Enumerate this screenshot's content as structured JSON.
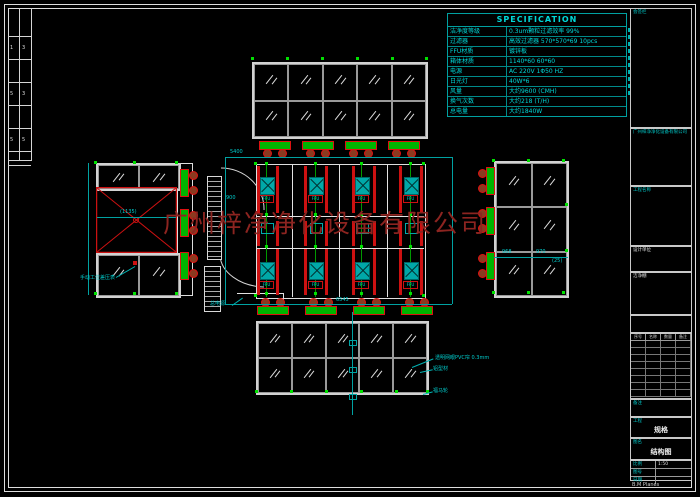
{
  "watermark": "广州梓净净化设备有限公司",
  "spec": {
    "title": "SPECIFICATION",
    "rows": [
      {
        "label": "洁净度等级",
        "value": "0.3um颗粒过滤效率 99%"
      },
      {
        "label": "过滤器",
        "value": "高效过滤器 570*570*69 10pcs"
      },
      {
        "label": "FFU材质",
        "value": "镀锌板"
      },
      {
        "label": "箱体材质",
        "value": "1140*60 60*60"
      },
      {
        "label": "电源",
        "value": "AC 220V 1Φ50 HZ"
      },
      {
        "label": "日光灯",
        "value": "40W*6"
      },
      {
        "label": "风量",
        "value": "大约9600 (CMH)"
      },
      {
        "label": "换气次数",
        "value": "大约218 (T/H)"
      },
      {
        "label": "总电量",
        "value": "大约1840W"
      }
    ]
  },
  "plan": {
    "ffu_tag": "FFU",
    "power_label": "总电源"
  },
  "labels": {
    "curtain": "透明网眼PVC帘 0.3mm",
    "profile": "铝型材",
    "caster": "福马轮",
    "gauge": "手动工位差压表"
  },
  "dims": {
    "plan_top": "5400",
    "door": "900",
    "plan_bottom": "6545",
    "right_a": "968",
    "right_b": "970",
    "right_c": "(25)",
    "left_center": "(1135)"
  },
  "edge_rows": [
    [
      "1",
      "3"
    ],
    [
      "5",
      "3"
    ],
    [
      "5",
      "5"
    ]
  ],
  "title_block": {
    "c1": "会签栏",
    "c2": "广州梓净净化设备有限公司",
    "c3": "工程名称",
    "c4": "设计单位",
    "c5": "洁净棚",
    "rev_headers": [
      "序号",
      "名称",
      "数量",
      "备注"
    ],
    "c8": "备注",
    "c9_label": "工程",
    "c9": "规格",
    "c10_label": "图名",
    "c10": "结构图",
    "grid": [
      {
        "label": "比例",
        "value": "1:50"
      },
      {
        "label": "图号",
        "value": ""
      },
      {
        "label": "日期",
        "value": ""
      }
    ],
    "bottom_note": "B.M Planes"
  }
}
